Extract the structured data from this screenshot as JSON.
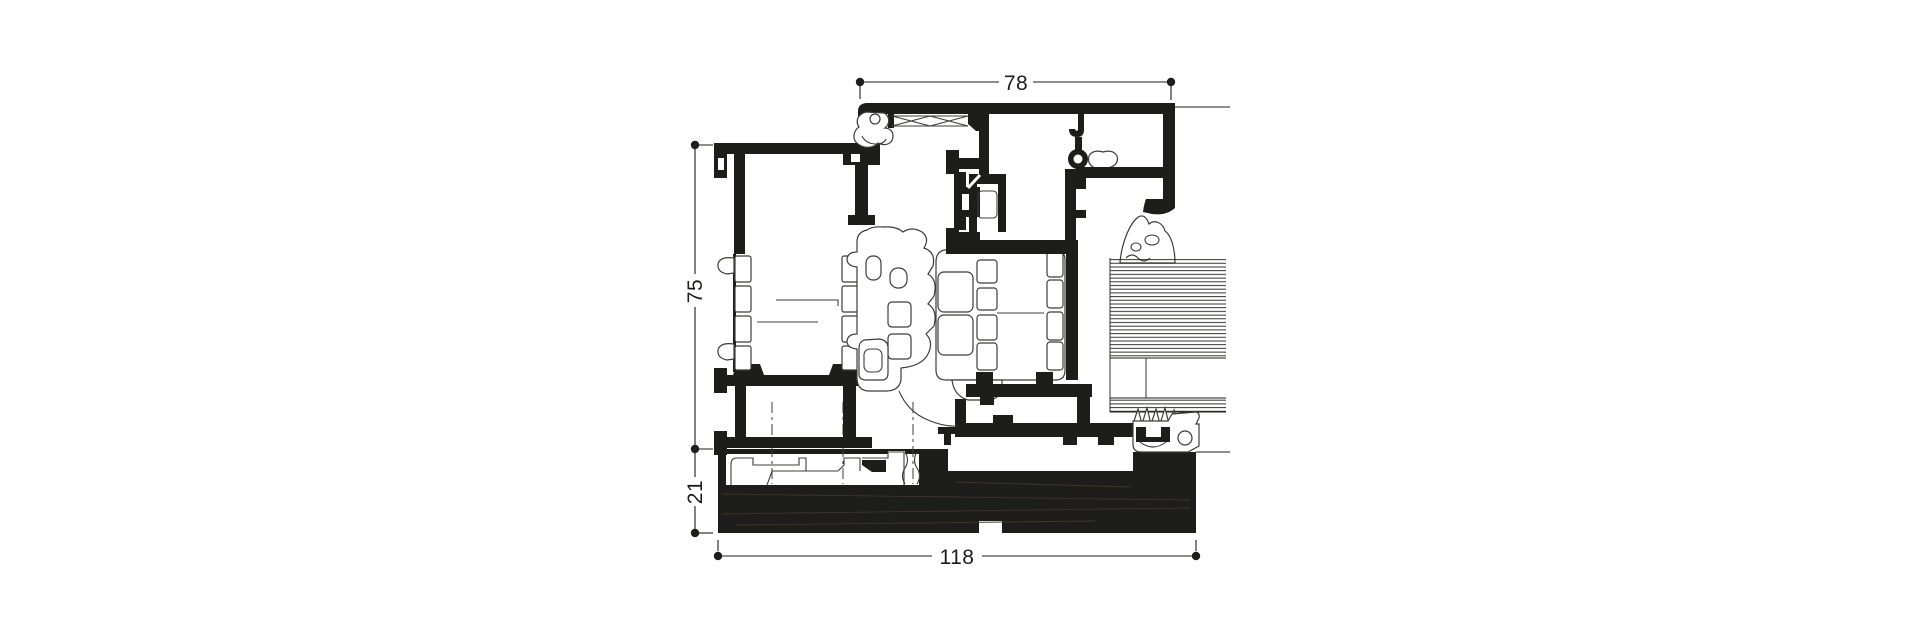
{
  "canvas": {
    "width": 1920,
    "height": 640,
    "background": "#ffffff"
  },
  "drawing": {
    "type": "technical-cross-section",
    "ink_color": "#1d1d1b",
    "threshold_fill_color": "#17130e",
    "dimensions": {
      "top": "78",
      "left_upper": "75",
      "left_lower": "21",
      "bottom": "118"
    }
  }
}
